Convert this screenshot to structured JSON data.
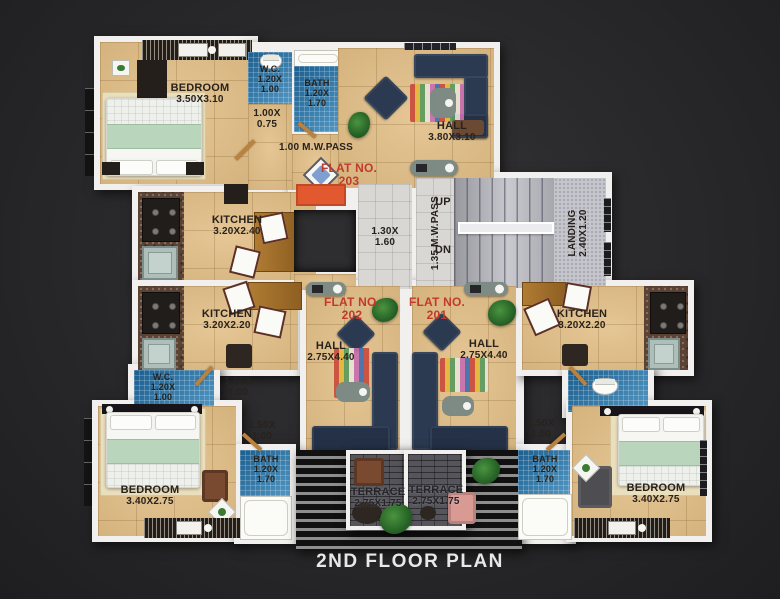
{
  "title": "2ND FLOOR PLAN",
  "colors": {
    "background": "#28282a",
    "wall": "#f1f0ee",
    "wood_floor": "#e2c089",
    "blue_tile": "#2b7fb5",
    "flat_number_red": "#c23a2c",
    "lift_orange": "#e2582f",
    "stair_grey": "#b9b9c1"
  },
  "flat203": {
    "label": "FLAT NO.",
    "number": "203",
    "hall": {
      "name": "HALL",
      "dims": "3.80X3.10"
    },
    "bedroom": {
      "name": "BEDROOM",
      "dims": "3.50X3.10"
    },
    "kitchen": {
      "name": "KITCHEN",
      "dims": "3.20X2.40"
    },
    "wc": {
      "name": "W.C.",
      "w": "1.20X",
      "h": "1.00"
    },
    "bath": {
      "name": "BATH",
      "w": "1.20X",
      "h": "1.70"
    },
    "pass": {
      "w": "1.00X",
      "h": "0.75"
    },
    "mwpass": "1.00 M.W.PASS"
  },
  "flat202": {
    "label": "FLAT NO.",
    "number": "202",
    "hall": {
      "name": "HALL",
      "dims": "2.75X4.40"
    },
    "kitchen": {
      "name": "KITCHEN",
      "dims": "3.20X2.20"
    },
    "wc": {
      "name": "W.C.",
      "w": "1.20X",
      "h": "1.00"
    },
    "bath": {
      "name": "BATH",
      "w": "1.20X",
      "h": "1.70"
    },
    "bedroom": {
      "name": "BEDROOM",
      "dims": "3.40X2.75"
    },
    "terrace": {
      "name": "TERRACE",
      "dims": "2.75X1.75"
    },
    "pass1": {
      "w": "1.50X",
      "h": "1.00"
    },
    "pass2": {
      "w": "1.50X",
      "h": "1.00"
    }
  },
  "flat201": {
    "label": "FLAT NO.",
    "number": "201",
    "hall": {
      "name": "HALL",
      "dims": "2.75X4.40"
    },
    "kitchen": {
      "name": "KITCHEN",
      "dims": "3.20X2.20"
    },
    "bath": {
      "name": "BATH",
      "w": "1.20X",
      "h": "1.70"
    },
    "bedroom": {
      "name": "BEDROOM",
      "dims": "3.40X2.75"
    },
    "terrace": {
      "name": "TERRACE",
      "dims": "2.75X1.75"
    },
    "pass": {
      "w": "1.50X",
      "h": "1.00"
    }
  },
  "common": {
    "lobby": {
      "w": "1.30X",
      "h": "1.60"
    },
    "mwpass": "1.35 M.W.PASS",
    "up": "UP",
    "dn": "DN",
    "landing": {
      "name": "LANDING",
      "dims": "2.40X1.20"
    }
  }
}
